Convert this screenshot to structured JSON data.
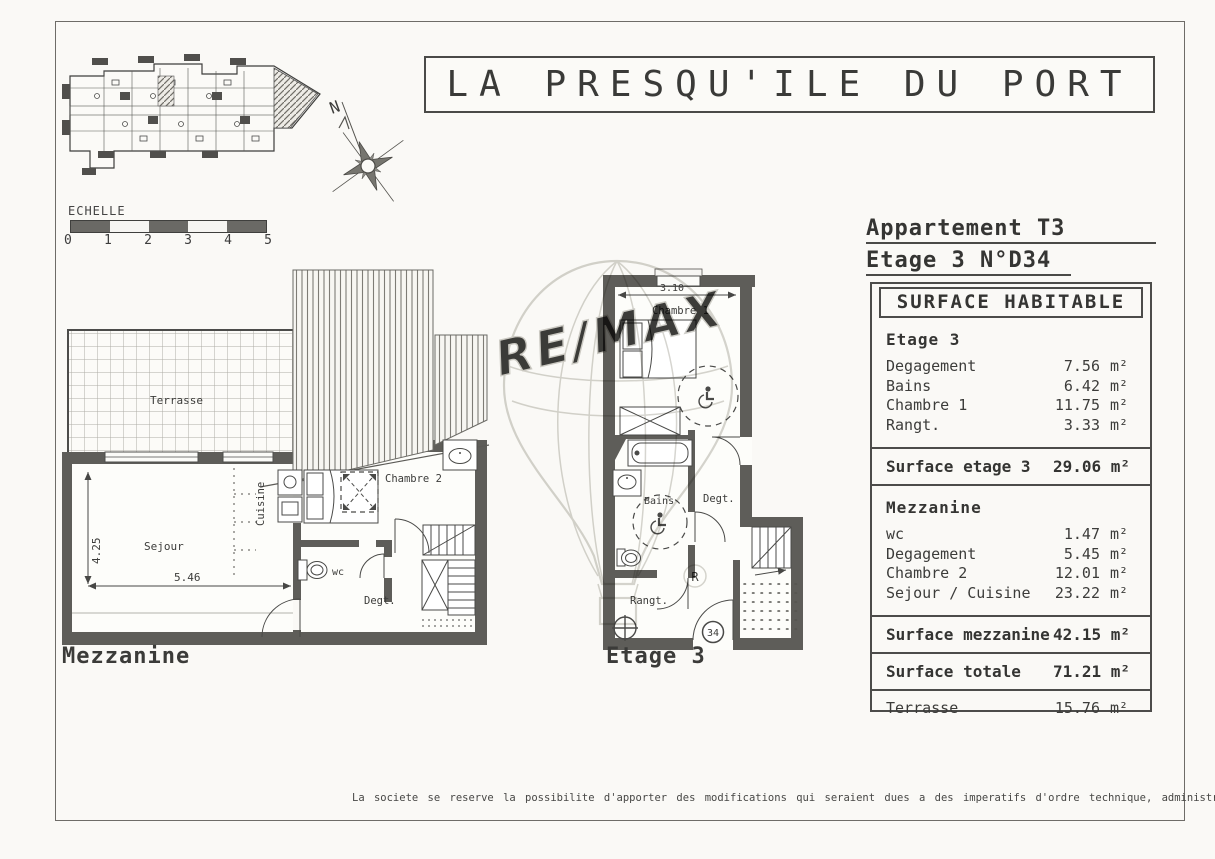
{
  "title": "LA PRESQU'ILE DU PORT",
  "compass": {
    "north": "N"
  },
  "scale_bar": {
    "label": "ECHELLE",
    "ticks": [
      "0",
      "1",
      "2",
      "3",
      "4",
      "5"
    ]
  },
  "plans": {
    "mezzanine": {
      "caption": "Mezzanine",
      "labels": {
        "terrasse": "Terrasse",
        "sejour": "Sejour",
        "cuisine": "Cuisine",
        "chambre2": "Chambre 2",
        "wc": "wc",
        "degt": "Degt."
      },
      "dims": {
        "height": "4.25",
        "width": "5.46"
      }
    },
    "etage3": {
      "caption": "Etage 3",
      "labels": {
        "chambre1": "Chambre 1",
        "bains": "Bains",
        "degt": "Degt.",
        "rangt": "Rangt."
      },
      "dims": {
        "width": "3.10",
        "height": "3.80"
      },
      "unit_badge": "34"
    }
  },
  "info": {
    "apartment_type": "Appartement T3",
    "unit_ref": "Etage 3 N°D34",
    "table_title": "SURFACE HABITABLE",
    "sections": [
      {
        "heading": "Etage 3",
        "rows": [
          {
            "label": "Degagement",
            "value": "7.56",
            "unit": "m²"
          },
          {
            "label": "Bains",
            "value": "6.42",
            "unit": "m²"
          },
          {
            "label": "Chambre 1",
            "value": "11.75",
            "unit": "m²"
          },
          {
            "label": "Rangt.",
            "value": "3.33",
            "unit": "m²"
          }
        ],
        "total_label": "Surface etage 3",
        "total_value": "29.06 m²"
      },
      {
        "heading": "Mezzanine",
        "rows": [
          {
            "label": "wc",
            "value": "1.47",
            "unit": "m²"
          },
          {
            "label": "Degagement",
            "value": "5.45",
            "unit": "m²"
          },
          {
            "label": "Chambre 2",
            "value": "12.01",
            "unit": "m²"
          },
          {
            "label": "Sejour / Cuisine",
            "value": "23.22",
            "unit": "m²"
          }
        ],
        "total_label": "Surface mezzanine",
        "total_value": "42.15 m²"
      }
    ],
    "grand_total_label": "Surface totale",
    "grand_total_value": "71.21 m²",
    "terrace_label": "Terrasse",
    "terrace_value": "15.76",
    "terrace_unit": "m²"
  },
  "watermark": {
    "brand": "RE/MAX",
    "registered": "R"
  },
  "footer": "La societe se reserve la possibilite d'apporter des modifications qui seraient dues a des imperatifs d'ordre technique, administratif ou normatif"
}
